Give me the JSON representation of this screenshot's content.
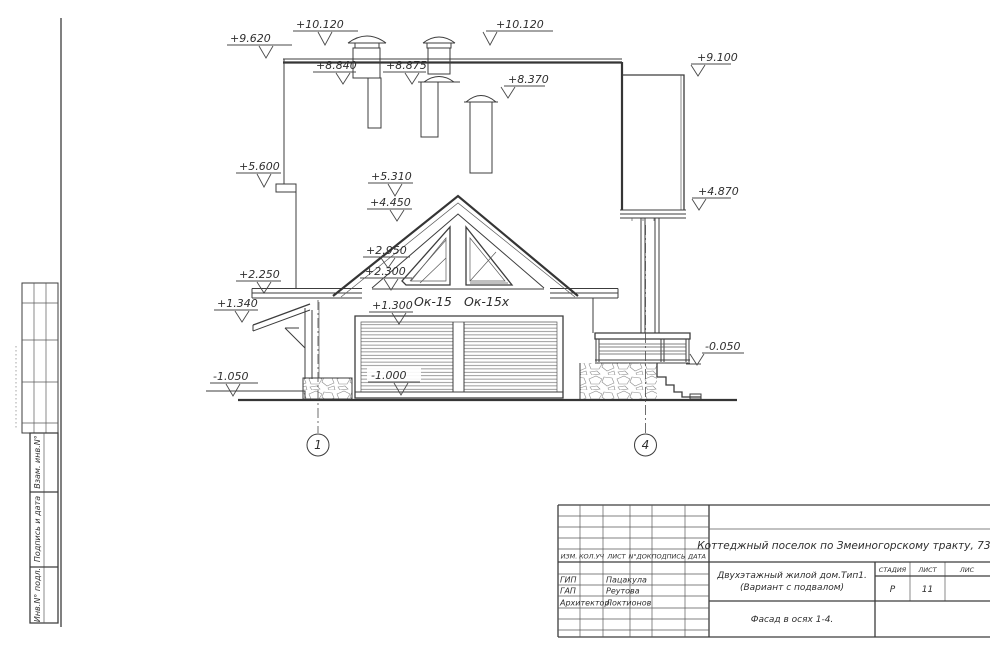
{
  "drawing": {
    "marks": {
      "p9620": "+9.620",
      "p10120l": "+10.120",
      "p10120r": "+10.120",
      "p8840": "+8.840",
      "p8875": "+8.875",
      "p8370": "+8.370",
      "p9100": "+9.100",
      "p4870": "+4.870",
      "p5600": "+5.600",
      "p5310": "+5.310",
      "p4450": "+4.450",
      "p2950": "+2.950",
      "p2300": "+2.300",
      "p2250": "+2.250",
      "p1340": "+1.340",
      "p1300": "+1.300",
      "m1050": "-1.050",
      "m1000": "-1.000",
      "m0050": "-0.050"
    },
    "windows": {
      "left": "Ок-15",
      "right": "Ок-15х"
    },
    "axes": {
      "left": "1",
      "right": "4"
    }
  },
  "sidebar": {
    "blocks": [
      "Взам. инв.N°",
      "Подпись и дата",
      "Инв.N° подл."
    ]
  },
  "titleblock": {
    "header_cols": [
      "ИЗМ.",
      "КОЛ.УЧ",
      "ЛИСТ",
      "N°ДОК.",
      "ПОДПИСЬ",
      "ДАТА"
    ],
    "roles": [
      {
        "role": "ГИП",
        "name": "Пацакула"
      },
      {
        "role": "ГАП",
        "name": "Реутова"
      },
      {
        "role": "Архитектор",
        "name": "Локтионов"
      }
    ],
    "project": "Коттеджный поселок по Змеиногорскому тракту, 73-б",
    "object_line1": "Двухэтажный жилой дом.Тип1.",
    "object_line2": "(Вариант с подвалом)",
    "stage_label": "СТАДИЯ",
    "sheet_label": "ЛИСТ",
    "sheets_label": "ЛИС",
    "stage_value": "Р",
    "sheet_value": "11",
    "view_title": "Фасад в осях 1-4."
  }
}
